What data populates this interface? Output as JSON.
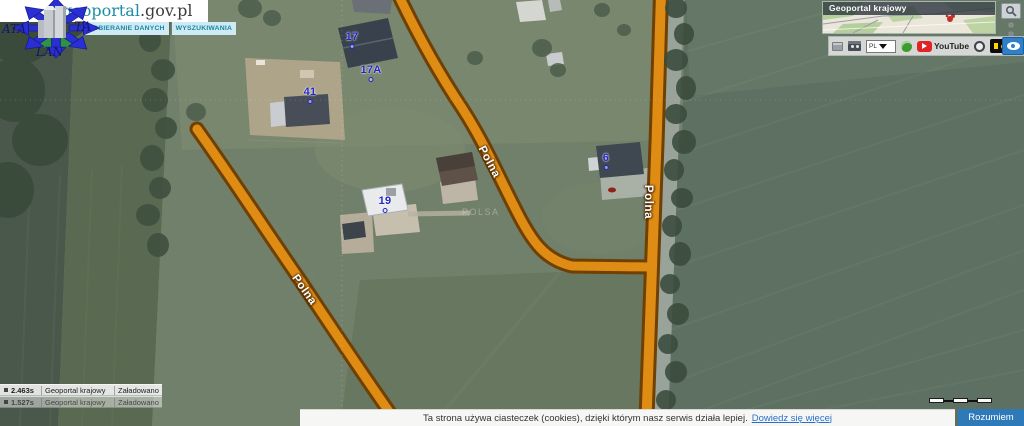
{
  "header": {
    "brand_primary": "geoportal",
    "brand_suffix": ".gov.pl",
    "menu": [
      "POBIERANIE DANYCH",
      "WYSZUKIWANIA"
    ]
  },
  "logo": {
    "frag_left": "ATA",
    "frag_right": "TA",
    "frag_bottom": "LAN"
  },
  "minimap": {
    "title": "Geoportal krajowy",
    "lang": "PL",
    "youtube": "YouTube"
  },
  "map": {
    "watermark": "POLSA",
    "house_labels": [
      {
        "text": "17"
      },
      {
        "text": "17A"
      },
      {
        "text": "41"
      },
      {
        "text": "19"
      },
      {
        "text": "6"
      }
    ],
    "street_labels": [
      {
        "text": "Polna"
      },
      {
        "text": "Polna"
      },
      {
        "text": "Polna"
      }
    ]
  },
  "status": {
    "rows": [
      {
        "time": "2.463s",
        "layer": "Geoportal krajowy",
        "state": "Załadowano"
      },
      {
        "time": "1.527s",
        "layer": "Geoportal krajowy",
        "state": "Załadowano"
      }
    ]
  },
  "cookie": {
    "message": "Ta strona używa ciasteczek (cookies), dzięki którym nasz serwis działa lepiej.",
    "link": "Dowiedz się więcej",
    "button": "Rozumiem"
  },
  "colors": {
    "road_orange": "#df8c14",
    "road_casing": "#6e4004",
    "label_blue": "#2326c9",
    "brand_teal": "#1d8ca6",
    "cookie_button": "#2e7ab8",
    "contrast_yellow": "#ffd400",
    "youtube_red": "#e02424"
  }
}
